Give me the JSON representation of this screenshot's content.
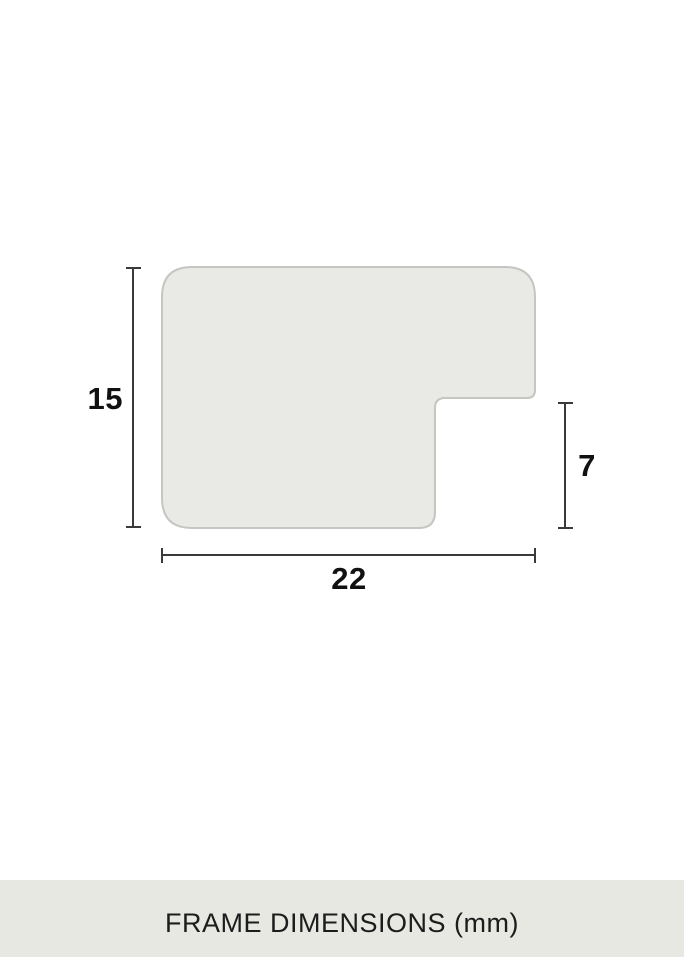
{
  "diagram": {
    "labels": {
      "height": "15",
      "width": "22",
      "depth": "7"
    }
  },
  "footer": {
    "caption": "FRAME DIMENSIONS (mm)"
  },
  "colors": {
    "background": "#ffffff",
    "shape_fill": "#e9e9e6",
    "shape_border": "#c5c5c1",
    "dimension_line": "#3a3a3a",
    "label_text": "#111111",
    "footer_bg": "#e8e8e3",
    "footer_text": "#1c1c1c"
  }
}
